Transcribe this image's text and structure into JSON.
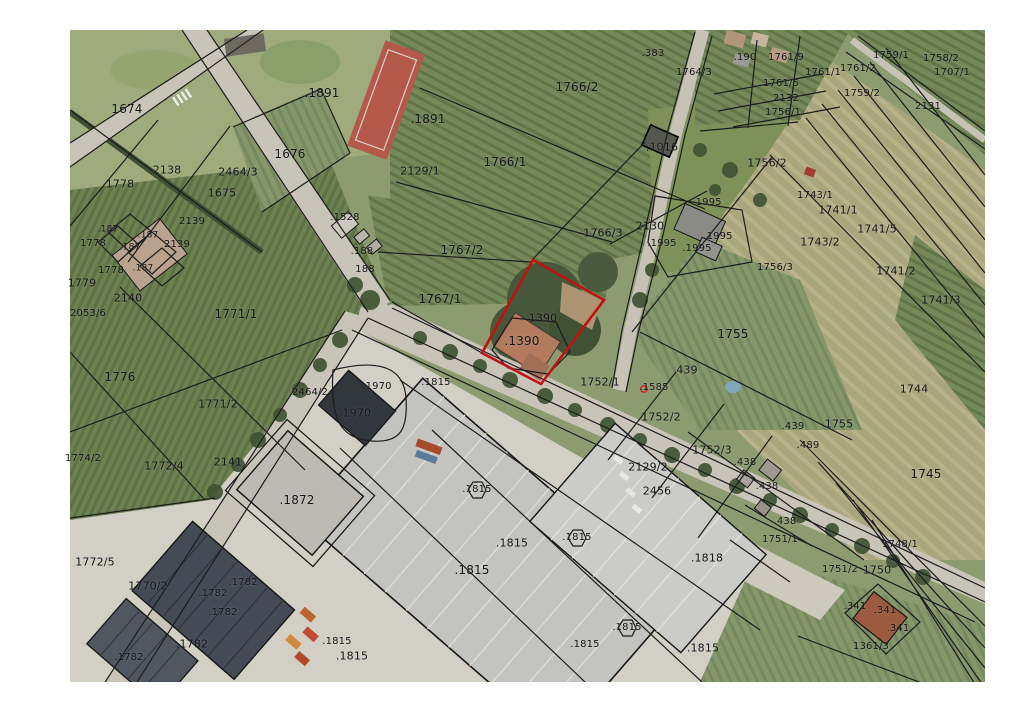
{
  "map": {
    "kind": "cadastral-parcel-map-over-aerial-imagery",
    "boundary_color": "#1c1c1c",
    "background_color": "#ffffff",
    "highlight": {
      "parcel_id": "1390",
      "color": "#c11212",
      "points": [
        [
          533,
          260
        ],
        [
          604,
          300
        ],
        [
          541,
          384
        ],
        [
          482,
          353
        ]
      ]
    },
    "survey_point": {
      "label": ".1585",
      "x": 654,
      "y": 388,
      "marker_color": "#cc2222",
      "marker_x": 644,
      "marker_y": 389
    },
    "parcel_labels": [
      {
        "t": ".383",
        "x": 653,
        "y": 54,
        "s": 10
      },
      {
        "t": "1764/3",
        "x": 694,
        "y": 73,
        "s": 10
      },
      {
        "t": ".190",
        "x": 745,
        "y": 58,
        "s": 10
      },
      {
        "t": "1761/9",
        "x": 786,
        "y": 58,
        "s": 10
      },
      {
        "t": "1761/1",
        "x": 823,
        "y": 73,
        "s": 10
      },
      {
        "t": "1761/2",
        "x": 858,
        "y": 69,
        "s": 10
      },
      {
        "t": "1759/1",
        "x": 891,
        "y": 56,
        "s": 10
      },
      {
        "t": "1758/2",
        "x": 941,
        "y": 59,
        "s": 10
      },
      {
        "t": "1707/1",
        "x": 952,
        "y": 73,
        "s": 10
      },
      {
        "t": "1761/5",
        "x": 781,
        "y": 84,
        "s": 10
      },
      {
        "t": "2132",
        "x": 786,
        "y": 99,
        "s": 10
      },
      {
        "t": "1756/1",
        "x": 783,
        "y": 113,
        "s": 10
      },
      {
        "t": "1759/2",
        "x": 862,
        "y": 94,
        "s": 10
      },
      {
        "t": "2131",
        "x": 928,
        "y": 107,
        "s": 10
      },
      {
        "t": ".1891",
        "x": 322,
        "y": 93,
        "s": 12
      },
      {
        "t": ".1891",
        "x": 428,
        "y": 119,
        "s": 12
      },
      {
        "t": "1674",
        "x": 127,
        "y": 109,
        "s": 12
      },
      {
        "t": "1676",
        "x": 290,
        "y": 154,
        "s": 12
      },
      {
        "t": "1766/2",
        "x": 577,
        "y": 87,
        "s": 12
      },
      {
        "t": "1766/1",
        "x": 505,
        "y": 162,
        "s": 12
      },
      {
        "t": ".1016",
        "x": 662,
        "y": 147,
        "s": 11
      },
      {
        "t": "2129/1",
        "x": 420,
        "y": 171,
        "s": 11
      },
      {
        "t": "2464/3",
        "x": 238,
        "y": 172,
        "s": 11
      },
      {
        "t": "2138",
        "x": 167,
        "y": 170,
        "s": 11
      },
      {
        "t": "1675",
        "x": 222,
        "y": 193,
        "s": 11
      },
      {
        "t": "1778",
        "x": 120,
        "y": 184,
        "s": 11
      },
      {
        "t": "2130",
        "x": 650,
        "y": 226,
        "s": 11
      },
      {
        "t": ".1995",
        "x": 707,
        "y": 203,
        "s": 10
      },
      {
        "t": ".1995",
        "x": 718,
        "y": 237,
        "s": 10
      },
      {
        "t": ".1995",
        "x": 662,
        "y": 244,
        "s": 10
      },
      {
        "t": ".1995",
        "x": 697,
        "y": 249,
        "s": 10
      },
      {
        "t": "1756/2",
        "x": 767,
        "y": 163,
        "s": 11
      },
      {
        "t": "1756/3",
        "x": 775,
        "y": 268,
        "s": 10
      },
      {
        "t": "1743/1",
        "x": 815,
        "y": 196,
        "s": 10
      },
      {
        "t": "1741/1",
        "x": 838,
        "y": 210,
        "s": 11
      },
      {
        "t": "1741/5",
        "x": 877,
        "y": 229,
        "s": 11
      },
      {
        "t": "1743/2",
        "x": 820,
        "y": 242,
        "s": 11
      },
      {
        "t": "1741/2",
        "x": 896,
        "y": 271,
        "s": 11
      },
      {
        "t": "1741/3",
        "x": 941,
        "y": 300,
        "s": 11
      },
      {
        "t": "1744",
        "x": 914,
        "y": 389,
        "s": 11
      },
      {
        "t": "1745",
        "x": 926,
        "y": 474,
        "s": 12
      },
      {
        "t": ".187",
        "x": 108,
        "y": 230,
        "s": 9
      },
      {
        "t": ".187",
        "x": 148,
        "y": 236,
        "s": 9
      },
      {
        "t": ".187",
        "x": 130,
        "y": 248,
        "s": 9
      },
      {
        "t": ".187",
        "x": 143,
        "y": 269,
        "s": 9
      },
      {
        "t": "1778",
        "x": 93,
        "y": 244,
        "s": 10
      },
      {
        "t": "1778",
        "x": 111,
        "y": 271,
        "s": 10
      },
      {
        "t": "1779",
        "x": 82,
        "y": 283,
        "s": 11
      },
      {
        "t": "2139",
        "x": 192,
        "y": 222,
        "s": 10
      },
      {
        "t": "2139",
        "x": 177,
        "y": 245,
        "s": 10
      },
      {
        "t": "2140",
        "x": 128,
        "y": 298,
        "s": 11
      },
      {
        "t": "2053/6",
        "x": 88,
        "y": 314,
        "s": 10
      },
      {
        "t": "1771/1",
        "x": 236,
        "y": 314,
        "s": 12
      },
      {
        "t": "1767/2",
        "x": 462,
        "y": 250,
        "s": 12
      },
      {
        "t": "1767/1",
        "x": 440,
        "y": 299,
        "s": 12
      },
      {
        "t": "1766/3",
        "x": 603,
        "y": 233,
        "s": 11
      },
      {
        "t": ".1528",
        "x": 345,
        "y": 218,
        "s": 10
      },
      {
        "t": ".188",
        "x": 362,
        "y": 252,
        "s": 10
      },
      {
        "t": "188",
        "x": 365,
        "y": 270,
        "s": 10
      },
      {
        "t": "1390",
        "x": 543,
        "y": 318,
        "s": 11
      },
      {
        "t": ".1390",
        "x": 522,
        "y": 341,
        "s": 12
      },
      {
        "t": "1776",
        "x": 120,
        "y": 377,
        "s": 12
      },
      {
        "t": "1771/2",
        "x": 218,
        "y": 404,
        "s": 11
      },
      {
        "t": "2464/2",
        "x": 310,
        "y": 393,
        "s": 10
      },
      {
        "t": ".1970",
        "x": 377,
        "y": 387,
        "s": 10
      },
      {
        "t": ".1970",
        "x": 355,
        "y": 413,
        "s": 11
      },
      {
        "t": ".1815",
        "x": 436,
        "y": 383,
        "s": 10
      },
      {
        "t": "1752/1",
        "x": 600,
        "y": 382,
        "s": 11
      },
      {
        "t": "439",
        "x": 687,
        "y": 370,
        "s": 11
      },
      {
        "t": "1755",
        "x": 733,
        "y": 334,
        "s": 12
      },
      {
        "t": "1755",
        "x": 839,
        "y": 424,
        "s": 11
      },
      {
        "t": ".439",
        "x": 793,
        "y": 427,
        "s": 10
      },
      {
        "t": ".489",
        "x": 808,
        "y": 446,
        "s": 10
      },
      {
        "t": "1752/2",
        "x": 661,
        "y": 417,
        "s": 11
      },
      {
        "t": "1752/3",
        "x": 712,
        "y": 450,
        "s": 11
      },
      {
        "t": "2129/2",
        "x": 648,
        "y": 467,
        "s": 11
      },
      {
        "t": "2456",
        "x": 657,
        "y": 491,
        "s": 11
      },
      {
        "t": ".438",
        "x": 745,
        "y": 463,
        "s": 10
      },
      {
        "t": ".438",
        "x": 767,
        "y": 487,
        "s": 10
      },
      {
        "t": ".438",
        "x": 785,
        "y": 522,
        "s": 10
      },
      {
        "t": ".1818",
        "x": 707,
        "y": 558,
        "s": 11
      },
      {
        "t": "1751/1",
        "x": 780,
        "y": 540,
        "s": 10
      },
      {
        "t": "1751/2",
        "x": 840,
        "y": 570,
        "s": 10
      },
      {
        "t": "1750",
        "x": 877,
        "y": 570,
        "s": 11
      },
      {
        "t": "1748/1",
        "x": 900,
        "y": 545,
        "s": 10
      },
      {
        "t": ".341",
        "x": 855,
        "y": 607,
        "s": 10
      },
      {
        "t": ".341",
        "x": 885,
        "y": 611,
        "s": 10
      },
      {
        "t": ".341",
        "x": 898,
        "y": 629,
        "s": 10
      },
      {
        "t": "1361/3",
        "x": 871,
        "y": 647,
        "s": 10
      },
      {
        "t": "1774/2",
        "x": 83,
        "y": 459,
        "s": 10
      },
      {
        "t": "1772/4",
        "x": 164,
        "y": 466,
        "s": 11
      },
      {
        "t": "2141",
        "x": 228,
        "y": 462,
        "s": 11
      },
      {
        "t": ".1872",
        "x": 297,
        "y": 500,
        "s": 12
      },
      {
        "t": "1772/5",
        "x": 95,
        "y": 562,
        "s": 11
      },
      {
        "t": "1770/2",
        "x": 148,
        "y": 586,
        "s": 11
      },
      {
        "t": ".1782",
        "x": 243,
        "y": 583,
        "s": 10
      },
      {
        "t": ".1782",
        "x": 213,
        "y": 594,
        "s": 10
      },
      {
        "t": ".1782",
        "x": 223,
        "y": 613,
        "s": 10
      },
      {
        "t": ".1782",
        "x": 192,
        "y": 644,
        "s": 11
      },
      {
        "t": ".1782",
        "x": 129,
        "y": 658,
        "s": 10
      },
      {
        "t": ".1815",
        "x": 477,
        "y": 490,
        "s": 10
      },
      {
        "t": ".1815",
        "x": 512,
        "y": 543,
        "s": 11
      },
      {
        "t": ".1815",
        "x": 577,
        "y": 538,
        "s": 10
      },
      {
        "t": ".1815",
        "x": 472,
        "y": 570,
        "s": 12
      },
      {
        "t": ".1815",
        "x": 627,
        "y": 628,
        "s": 10
      },
      {
        "t": ".1815",
        "x": 585,
        "y": 645,
        "s": 10
      },
      {
        "t": ".1815",
        "x": 703,
        "y": 648,
        "s": 11
      },
      {
        "t": ".1815",
        "x": 337,
        "y": 642,
        "s": 10
      },
      {
        "t": ".1815",
        "x": 352,
        "y": 656,
        "s": 11
      }
    ]
  }
}
